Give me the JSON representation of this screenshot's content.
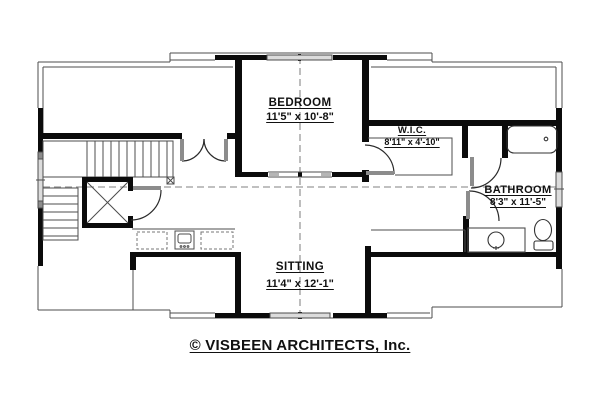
{
  "plan": {
    "rooms": [
      {
        "id": "bedroom",
        "label": "BEDROOM",
        "dims": "11'5\" x 10'-8\""
      },
      {
        "id": "wic",
        "label": "W.I.C.",
        "dims": "8'11\" x 4'-10\""
      },
      {
        "id": "bathroom",
        "label": "BATHROOM",
        "dims": "8'3\" x 11'-5\""
      },
      {
        "id": "sitting",
        "label": "SITTING",
        "dims": "11'4\" x 12'-1\""
      }
    ],
    "footer": "© VISBEEN ARCHITECTS, Inc.",
    "fixtures": [
      "bathtub",
      "toilet",
      "vanity-sink",
      "kitchen-sink",
      "stairs",
      "elevator"
    ],
    "colors": {
      "wall": "#0b0b0b",
      "thin_line": "#4d4d4d",
      "dash": "#9a9a9a",
      "door_leaf": "#8c8c8c",
      "window_fill": "#dcdcdc"
    }
  }
}
